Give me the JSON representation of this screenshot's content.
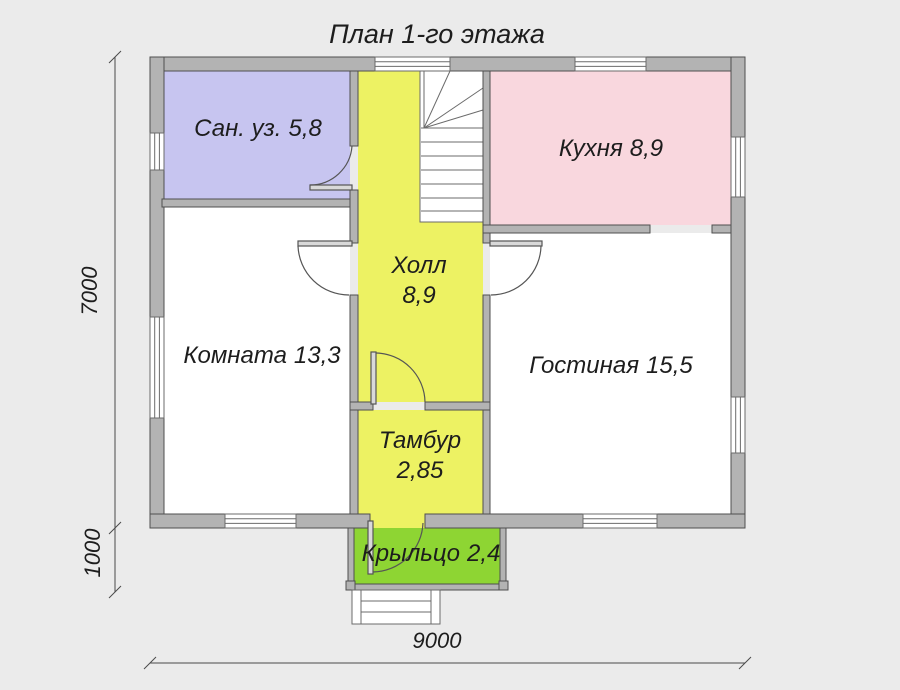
{
  "title": "План 1-го этажа",
  "colors": {
    "background": "#ebebeb",
    "wall_fill": "#b3b3b3",
    "wall_stroke": "#4f4f4f",
    "line": "#5a5a5a",
    "text": "#1d1d1d",
    "window_fill": "#ffffff"
  },
  "rooms": [
    {
      "name": "Сан. уз.",
      "area": "5,8",
      "color": "#c7c5f0"
    },
    {
      "name": "Кухня",
      "area": "8,9",
      "color": "#f9d7de"
    },
    {
      "name": "Холл",
      "area": "8,9",
      "color": "#edf263"
    },
    {
      "name": "Комната",
      "area": "13,3",
      "color": "#ffffff"
    },
    {
      "name": "Гостиная",
      "area": "15,5",
      "color": "#ffffff"
    },
    {
      "name": "Тамбур",
      "area": "2,85",
      "color": "#edf263"
    },
    {
      "name": "Крыльцо",
      "area": "2,4",
      "color": "#8ed533"
    }
  ],
  "dimensions": {
    "overall_width_mm": "9000",
    "overall_height_mm": "7000",
    "porch_depth_mm": "1000"
  }
}
